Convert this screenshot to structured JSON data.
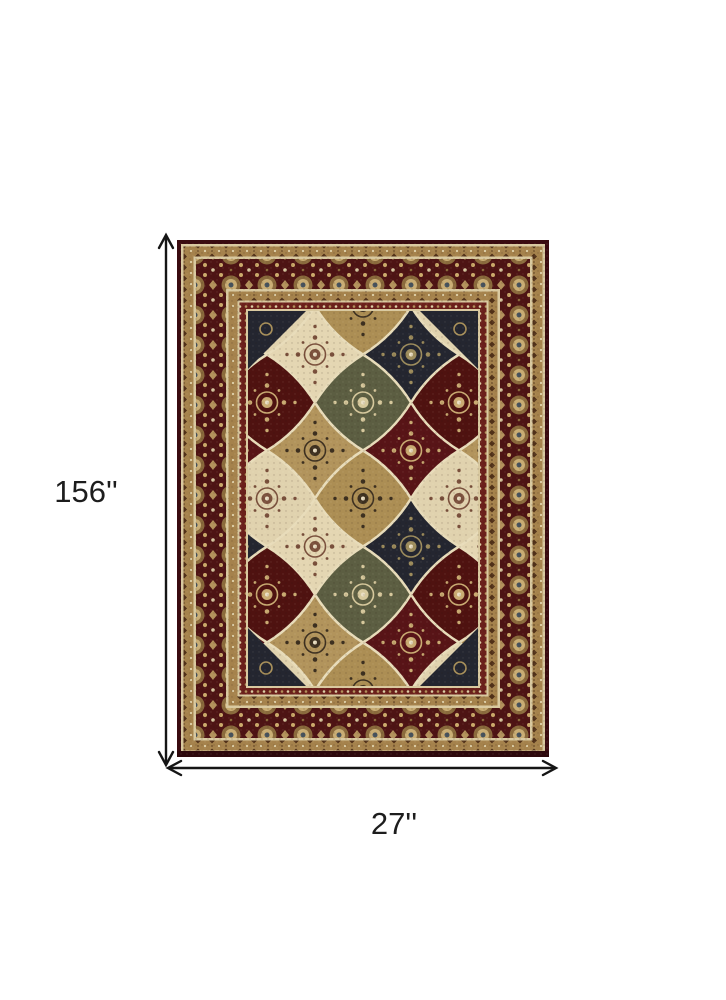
{
  "scene": {
    "description": "area rug product dimension diagram",
    "background_color": "#ffffff"
  },
  "dimensions": {
    "height_label": "156''",
    "width_label": "27''"
  },
  "annotation": {
    "height_arrow": "vertical-double-headed-arrow",
    "width_arrow": "horizontal-double-headed-arrow",
    "arrow_color": "#151515",
    "label_color": "#1d1d1d"
  },
  "rug": {
    "style": "oriental-panel-patchwork",
    "edge_color": "#3a0b10",
    "main_border_color": "#4e1414",
    "guard_band_color": "#a5824c",
    "accent_cream": "#d9c9a0",
    "minor_band_color": "#6b201b",
    "panel_colors": [
      "#e4d6b2",
      "#b2945c",
      "#581417",
      "#242630",
      "#5c5e42"
    ],
    "rosette_gold": "#c9ad74",
    "rosette_center": "#46525c"
  }
}
